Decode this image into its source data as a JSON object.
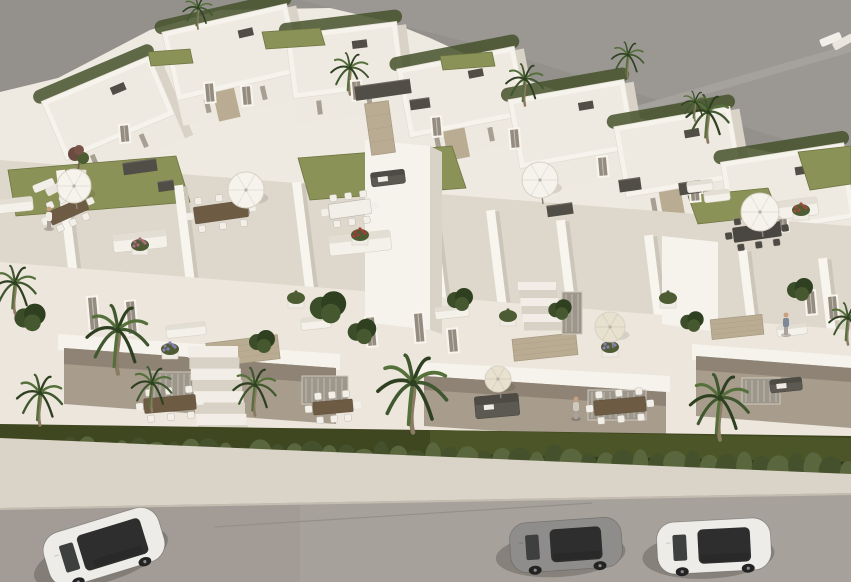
{
  "meta": {
    "type": "3d-architectural-render",
    "description": "Aerial 3D rendering of a modern white residential development with rooftop terraces, lawns, parasols, palm trees, front gardens, a hedge row and a street with three parked cars (white SUV, gray coupe, white sedan)"
  },
  "colors": {
    "bg": "#94918d",
    "bg_light": "#9b9894",
    "ground_path": "#a5a29d",
    "mass": "#efeae1",
    "building_white": "#f6f3ed",
    "building_face": "#eee9e0",
    "building_shadow": "#d8d2c7",
    "roof_edge": "#e2dcd1",
    "roof_inner": "#efeae1",
    "terrace": "#ded7cb",
    "facade": "#ece6dc",
    "deep_shadow": "#a89d8d",
    "deeper_shadow": "#8e8374",
    "stone": "#b9ac92",
    "stone_dark": "#a5987e",
    "dark_fixture": "#514e47",
    "lawn_roof": "#8b9258",
    "garden": "#3f4721",
    "garden_light": "#4c5527",
    "hedge": "#5a673e",
    "hedge_dark": "#45512c",
    "hedge_base": "#333d1e",
    "palm": "#41572f",
    "palm_dark": "#2e4021",
    "palm_light": "#55703a",
    "trunk": "#8b7b64",
    "sidewalk": "#dad3c7",
    "curb": "#c3bcb0",
    "road": "#a7a19b",
    "road_left": "#a29b96",
    "umbrella_white": "#f6f3ec",
    "umbrella_beige": "#e9e1cf",
    "wood": "#6e5b43",
    "glass": "#2d2e2d",
    "car_white": "#eeece8",
    "car_gray": "#8e8d8b",
    "skin": "#c99f7f"
  },
  "scene": {
    "villas": [
      {
        "x": 108,
        "y": 108,
        "w": 118,
        "h": 64,
        "r": -23,
        "s": 0
      },
      {
        "x": 232,
        "y": 52,
        "w": 128,
        "h": 70,
        "r": -13,
        "s": 1
      },
      {
        "x": 345,
        "y": 60,
        "w": 112,
        "h": 64,
        "r": -7,
        "s": 0
      },
      {
        "x": 462,
        "y": 92,
        "w": 120,
        "h": 70,
        "r": -11,
        "s": 1
      },
      {
        "x": 572,
        "y": 124,
        "w": 118,
        "h": 70,
        "r": -10,
        "s": 0
      },
      {
        "x": 678,
        "y": 152,
        "w": 118,
        "h": 72,
        "r": -10,
        "s": 1
      },
      {
        "x": 788,
        "y": 190,
        "w": 125,
        "h": 76,
        "r": -9,
        "s": 0
      }
    ],
    "walls": [
      {
        "x": 62,
        "y": 170,
        "h": 105
      },
      {
        "x": 180,
        "y": 185,
        "h": 100
      },
      {
        "x": 298,
        "y": 182,
        "h": 110
      },
      {
        "x": 372,
        "y": 150,
        "h": 160
      },
      {
        "x": 432,
        "y": 205,
        "h": 100
      },
      {
        "x": 492,
        "y": 210,
        "h": 115
      },
      {
        "x": 562,
        "y": 220,
        "h": 105
      },
      {
        "x": 650,
        "y": 235,
        "h": 115
      },
      {
        "x": 744,
        "y": 250,
        "h": 110
      },
      {
        "x": 824,
        "y": 258,
        "h": 100
      }
    ],
    "lawns": [
      {
        "p": "8,170 176,156 190,202 16,216",
        "c": "lawn_roof"
      },
      {
        "p": "298,158 452,146 466,188 310,200",
        "c": "lawn_roof"
      },
      {
        "p": "688,196 768,188 779,215 698,224",
        "c": "lawn_roof"
      },
      {
        "p": "798,152 851,146 851,184 810,190",
        "c": "lawn_roof"
      },
      {
        "p": "262,32 320,28 325,45 266,49",
        "c": "lawn_roof"
      },
      {
        "p": "148,52 190,49 193,63 151,66",
        "c": "lawn_roof"
      },
      {
        "p": "440,56 492,52 495,66 443,70",
        "c": "lawn_roof"
      }
    ],
    "stones": [
      {
        "x": 243,
        "y": 351,
        "w": 72,
        "h": 24,
        "r": -7
      },
      {
        "x": 545,
        "y": 347,
        "w": 64,
        "h": 22,
        "r": -6
      },
      {
        "x": 737,
        "y": 327,
        "w": 52,
        "h": 20,
        "r": -6
      },
      {
        "x": 380,
        "y": 128,
        "w": 24,
        "h": 52,
        "r": -8
      }
    ],
    "windows": [
      {
        "x": 120,
        "y": 126,
        "h": 16
      },
      {
        "x": 205,
        "y": 84,
        "h": 18
      },
      {
        "x": 242,
        "y": 87,
        "h": 18
      },
      {
        "x": 352,
        "y": 82,
        "h": 18
      },
      {
        "x": 432,
        "y": 118,
        "h": 18
      },
      {
        "x": 510,
        "y": 130,
        "h": 18
      },
      {
        "x": 598,
        "y": 158,
        "h": 18
      },
      {
        "x": 690,
        "y": 183,
        "h": 18
      },
      {
        "x": 778,
        "y": 213,
        "h": 18
      },
      {
        "x": 88,
        "y": 298,
        "h": 32
      },
      {
        "x": 126,
        "y": 302,
        "h": 32
      },
      {
        "x": 366,
        "y": 318,
        "h": 28
      },
      {
        "x": 414,
        "y": 314,
        "h": 28
      },
      {
        "x": 448,
        "y": 330,
        "h": 22
      },
      {
        "x": 806,
        "y": 292,
        "h": 22
      },
      {
        "x": 828,
        "y": 297,
        "h": 22
      }
    ],
    "glazings": [
      {
        "x": 150,
        "y": 372,
        "w": 56,
        "h": 30
      },
      {
        "x": 302,
        "y": 376,
        "w": 46,
        "h": 28
      },
      {
        "x": 588,
        "y": 390,
        "w": 58,
        "h": 30
      },
      {
        "x": 742,
        "y": 378,
        "w": 38,
        "h": 26
      },
      {
        "x": 536,
        "y": 288,
        "w": 20,
        "h": 42
      },
      {
        "x": 562,
        "y": 292,
        "w": 20,
        "h": 42
      }
    ],
    "stairs": [
      {
        "x": 188,
        "y": 346,
        "w": 50,
        "n": 11,
        "dx": 1.4,
        "dy": 11.3
      },
      {
        "x": 518,
        "y": 282,
        "w": 38,
        "n": 6,
        "dx": 1.2,
        "dy": 8
      }
    ],
    "furniture": [
      {
        "t": "box",
        "x": 140,
        "y": 167,
        "w": 34,
        "h": 12,
        "r": -8
      },
      {
        "t": "box",
        "x": 166,
        "y": 186,
        "w": 16,
        "h": 10,
        "r": -8
      },
      {
        "t": "box",
        "x": 383,
        "y": 90,
        "w": 56,
        "h": 14,
        "r": -8
      },
      {
        "t": "box",
        "x": 420,
        "y": 104,
        "w": 20,
        "h": 10,
        "r": -8
      },
      {
        "t": "box",
        "x": 630,
        "y": 185,
        "w": 22,
        "h": 12,
        "r": -8
      },
      {
        "t": "box",
        "x": 690,
        "y": 188,
        "w": 22,
        "h": 12,
        "r": -8
      },
      {
        "t": "box",
        "x": 560,
        "y": 210,
        "w": 26,
        "h": 11,
        "r": -8
      },
      {
        "t": "sofa",
        "x": 15,
        "y": 205,
        "w": 36,
        "h": 14,
        "r": -6
      },
      {
        "t": "sofa",
        "x": 140,
        "y": 241,
        "w": 54,
        "h": 18,
        "r": -6
      },
      {
        "t": "sofa",
        "x": 360,
        "y": 243,
        "w": 62,
        "h": 20,
        "r": -6
      },
      {
        "t": "sofa",
        "x": 790,
        "y": 209,
        "w": 56,
        "h": 18,
        "r": -7
      },
      {
        "t": "sofa",
        "x": 186,
        "y": 330,
        "w": 40,
        "h": 13,
        "r": -6
      },
      {
        "t": "sofa",
        "x": 316,
        "y": 323,
        "w": 30,
        "h": 12,
        "r": -6
      },
      {
        "t": "sofa",
        "x": 700,
        "y": 186,
        "w": 26,
        "h": 11,
        "r": -7
      },
      {
        "t": "sofa",
        "x": 717,
        "y": 196,
        "w": 26,
        "h": 11,
        "r": -7
      },
      {
        "t": "sofa",
        "x": 452,
        "y": 312,
        "w": 34,
        "h": 12,
        "r": -6
      },
      {
        "t": "sofa",
        "x": 792,
        "y": 330,
        "w": 30,
        "h": 11,
        "r": -7
      },
      {
        "t": "daybed",
        "x": 497,
        "y": 406,
        "w": 44,
        "h": 22,
        "r": -5
      },
      {
        "t": "daybed",
        "x": 786,
        "y": 385,
        "w": 32,
        "h": 13,
        "r": -6
      },
      {
        "t": "daybed",
        "x": 388,
        "y": 178,
        "w": 34,
        "h": 14,
        "r": -7
      },
      {
        "t": "loungers",
        "x": 45,
        "y": 186
      },
      {
        "t": "loungers",
        "x": 832,
        "y": 40
      },
      {
        "t": "table",
        "x": 68,
        "y": 211,
        "w": 40,
        "h": 14,
        "r": -24,
        "top": "wood",
        "ch": "white"
      },
      {
        "t": "table",
        "x": 221,
        "y": 212,
        "w": 54,
        "h": 17,
        "r": -8,
        "top": "wood",
        "ch": "white"
      },
      {
        "t": "table",
        "x": 350,
        "y": 209,
        "w": 42,
        "h": 15,
        "r": -8,
        "top": "white",
        "ch": "white"
      },
      {
        "t": "table",
        "x": 757,
        "y": 232,
        "w": 48,
        "h": 15,
        "r": -8,
        "top": "dark",
        "ch": "dark"
      },
      {
        "t": "table",
        "x": 170,
        "y": 404,
        "w": 52,
        "h": 15,
        "r": -5,
        "top": "wood",
        "ch": "white"
      },
      {
        "t": "table",
        "x": 333,
        "y": 407,
        "w": 40,
        "h": 13,
        "r": -5,
        "top": "wood",
        "ch": "white"
      },
      {
        "t": "table",
        "x": 620,
        "y": 406,
        "w": 52,
        "h": 15,
        "r": -5,
        "top": "wood",
        "ch": "white"
      },
      {
        "t": "planter",
        "x": 170,
        "y": 351,
        "c": "#8a7fb5"
      },
      {
        "t": "planter",
        "x": 610,
        "y": 349,
        "c": "#8a7fb5"
      },
      {
        "t": "planter",
        "x": 140,
        "y": 247,
        "c": "#b06a80"
      },
      {
        "t": "planter",
        "x": 360,
        "y": 237,
        "c": "#a43c37"
      },
      {
        "t": "planter",
        "x": 801,
        "y": 212,
        "c": "#9c4a3c"
      },
      {
        "t": "planter",
        "x": 508,
        "y": 318,
        "c": "#4d5c33"
      },
      {
        "t": "planter",
        "x": 296,
        "y": 300,
        "c": "#4d5c33"
      },
      {
        "t": "planter",
        "x": 668,
        "y": 300,
        "c": "#4d5c33"
      },
      {
        "t": "tree",
        "x": 78,
        "y": 170
      }
    ],
    "umbrellas": [
      {
        "x": 74,
        "y": 186,
        "r": 17,
        "c": "umbrella_white"
      },
      {
        "x": 246,
        "y": 190,
        "r": 18,
        "c": "umbrella_white"
      },
      {
        "x": 540,
        "y": 180,
        "r": 18,
        "c": "umbrella_white"
      },
      {
        "x": 760,
        "y": 212,
        "r": 19,
        "c": "umbrella_white"
      },
      {
        "x": 610,
        "y": 327,
        "r": 15,
        "c": "umbrella_beige"
      },
      {
        "x": 498,
        "y": 379,
        "r": 13,
        "c": "umbrella_beige"
      }
    ],
    "people": [
      {
        "x": 49,
        "y": 216,
        "shirt": "#f0ece4"
      },
      {
        "x": 576,
        "y": 406,
        "shirt": "#cfc8bc"
      },
      {
        "x": 786,
        "y": 322,
        "shirt": "#7d8898"
      }
    ],
    "palms_rear": [
      {
        "x": 350,
        "y": 68,
        "s": 0.7
      },
      {
        "x": 525,
        "y": 79,
        "s": 0.7
      },
      {
        "x": 628,
        "y": 55,
        "s": 0.6
      },
      {
        "x": 708,
        "y": 112,
        "s": 0.8
      },
      {
        "x": 198,
        "y": 8,
        "s": 0.55
      },
      {
        "x": 695,
        "y": 102,
        "s": 0.5
      }
    ],
    "palms_front": [
      {
        "x": 118,
        "y": 330,
        "s": 1.15
      },
      {
        "x": 40,
        "y": 393,
        "s": 0.85
      },
      {
        "x": 152,
        "y": 383,
        "s": 0.75
      },
      {
        "x": 255,
        "y": 385,
        "s": 0.8
      },
      {
        "x": 413,
        "y": 383,
        "s": 1.3
      },
      {
        "x": 720,
        "y": 398,
        "s": 1.1
      },
      {
        "x": 15,
        "y": 283,
        "s": 0.8
      },
      {
        "x": 848,
        "y": 318,
        "s": 0.7
      }
    ],
    "bushes": [
      {
        "x": 328,
        "y": 308,
        "r": 14
      },
      {
        "x": 362,
        "y": 332,
        "r": 11
      },
      {
        "x": 30,
        "y": 318,
        "r": 12
      },
      {
        "x": 262,
        "y": 342,
        "r": 10
      },
      {
        "x": 800,
        "y": 290,
        "r": 10
      },
      {
        "x": 692,
        "y": 322,
        "r": 9
      },
      {
        "x": 460,
        "y": 300,
        "r": 10
      },
      {
        "x": 560,
        "y": 310,
        "r": 9
      }
    ],
    "hedge": {
      "x0": 70,
      "x1": 848,
      "y0": 452,
      "y1": 470,
      "count": 46
    },
    "cars": [
      {
        "t": "suv",
        "x": 104,
        "y": 547,
        "w": 120,
        "h": 56,
        "r": -17,
        "body": "car_white"
      },
      {
        "t": "coupe",
        "x": 566,
        "y": 545,
        "w": 112,
        "h": 50,
        "r": -4,
        "body": "car_gray"
      },
      {
        "t": "sedan",
        "x": 714,
        "y": 546,
        "w": 114,
        "h": 52,
        "r": -3,
        "body": "car_white"
      }
    ]
  }
}
